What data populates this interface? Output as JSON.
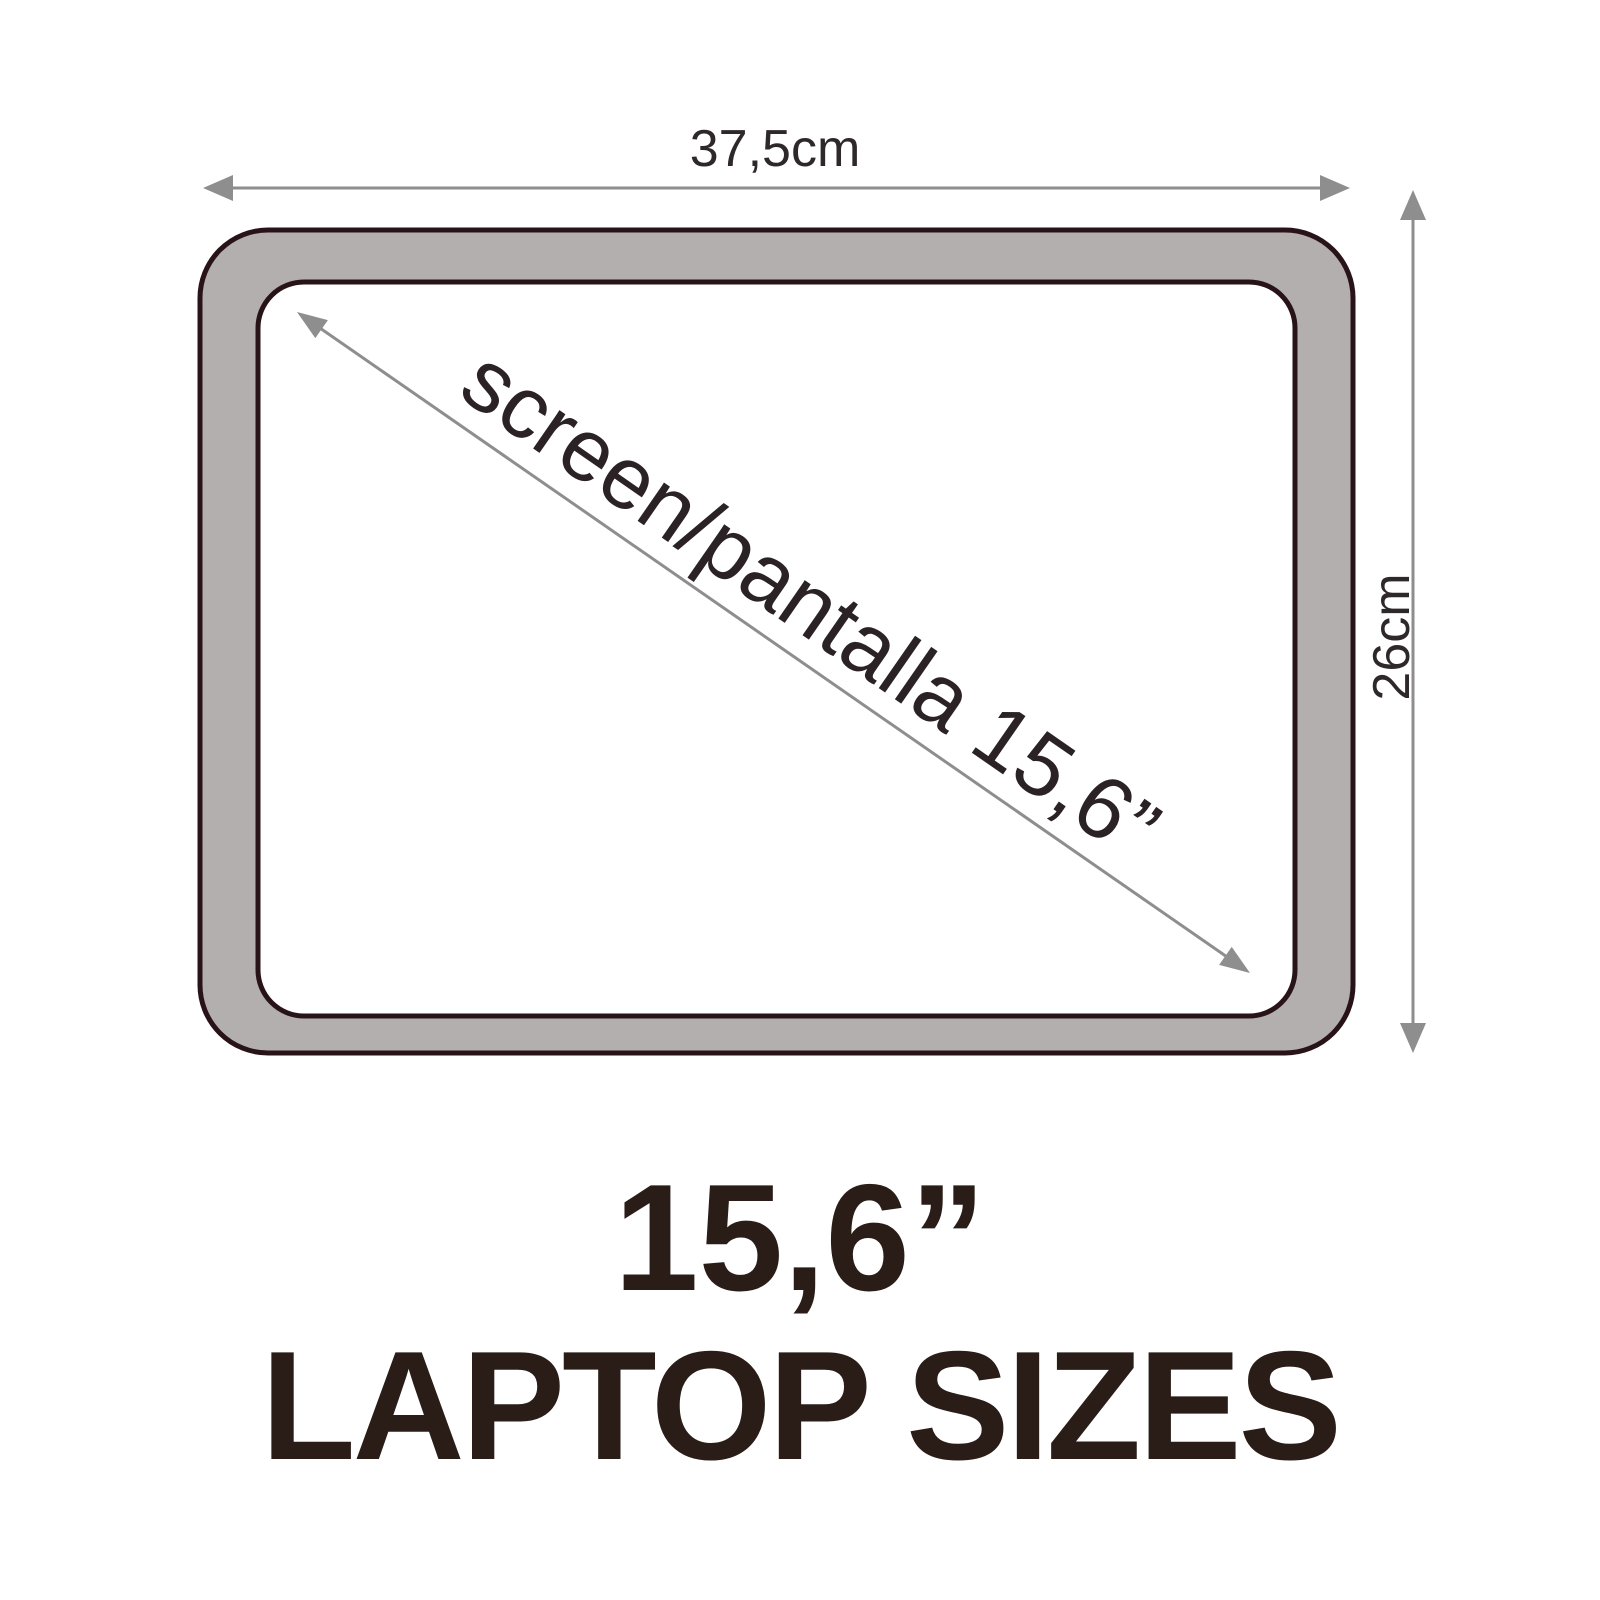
{
  "colors": {
    "bezel_gray": "#b3afae",
    "outline_dark": "#281418",
    "arrow_gray": "#8e8e8e",
    "label_text": "#2f282a",
    "title_text": "#2a1d18",
    "screen_white": "#ffffff"
  },
  "dimension_labels": {
    "width": "37,5cm",
    "height": "26cm",
    "diagonal": "screen/pantalla 15,6”"
  },
  "title": {
    "size": "15,6”",
    "caption": "LAPTOP SIZES"
  }
}
